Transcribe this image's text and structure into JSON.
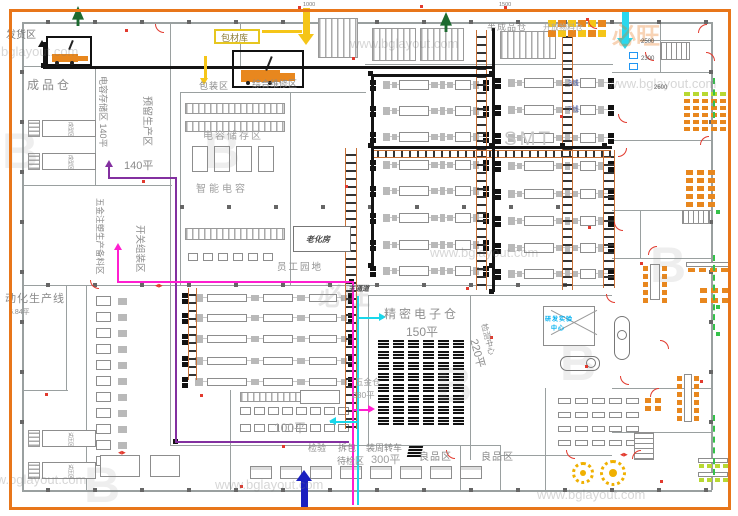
{
  "labels": {
    "fahuo": "发货区",
    "chengpin": "成品仓",
    "chengxing": "成型区",
    "shiya": "试压区",
    "dianrong_cun": "电容存储区 140平",
    "yuliu": "预留生产区",
    "p140": "140平",
    "wujin_beiliao": "五金注塑生产备料区",
    "kaiguan": "开关组装区",
    "donghua": "动化生产线",
    "p684": "6.84平",
    "baocai": "包材库",
    "baozhuang": "包装区",
    "weixiu": "综合维修区",
    "dianrong_chu": "电容储存区",
    "zhineng": "智能电容",
    "laohua": "老化房",
    "yuangong": "员工园地",
    "bancheng": "半成品仓",
    "kaifang": "开放物料仓",
    "smt": "SMT",
    "line3": "3线",
    "line7": "7线",
    "jingmi": "精密电子仓",
    "p150": "150平",
    "zhutongdao": "主通道",
    "jiance": "检测中心",
    "p220": "220平",
    "wujincang": "五金仓",
    "p280": "280平",
    "p100": "100平",
    "jianyan": "检验",
    "chaibao": "拆包",
    "zhuangzhou": "装周转车",
    "daijian": "待检区",
    "p300": "300平",
    "liangpin_a": "良品区",
    "liangpin_b": "良品区",
    "yanfa_l1": "研发实验",
    "yanfa_l2": "中心"
  },
  "dims": {
    "d2500": "2500",
    "d2300": "2300",
    "d2600": "2600",
    "d1500": "1500",
    "d1000": "1000"
  },
  "watermark": {
    "url": "www.bglayout.com",
    "logo_cn": "必旺",
    "logo_mark": "B"
  },
  "colors": {
    "frame": "#e8761a",
    "wall": "#9aa0a0",
    "heavy": "#141414",
    "conveyor": "#c87137",
    "furniture": "#e8871e",
    "lime": "#b8d832",
    "table_yellow": "#f0b000",
    "door_red": "#e23a2e",
    "tree": "#1d6b30",
    "purple": "#8330a0",
    "magenta": "#ff1fd0",
    "cyan": "#19d7ea",
    "yellow": "#f5c518",
    "blue": "#1a1fbf",
    "cyan_text": "#00b0f0",
    "green": "#35c24a"
  }
}
